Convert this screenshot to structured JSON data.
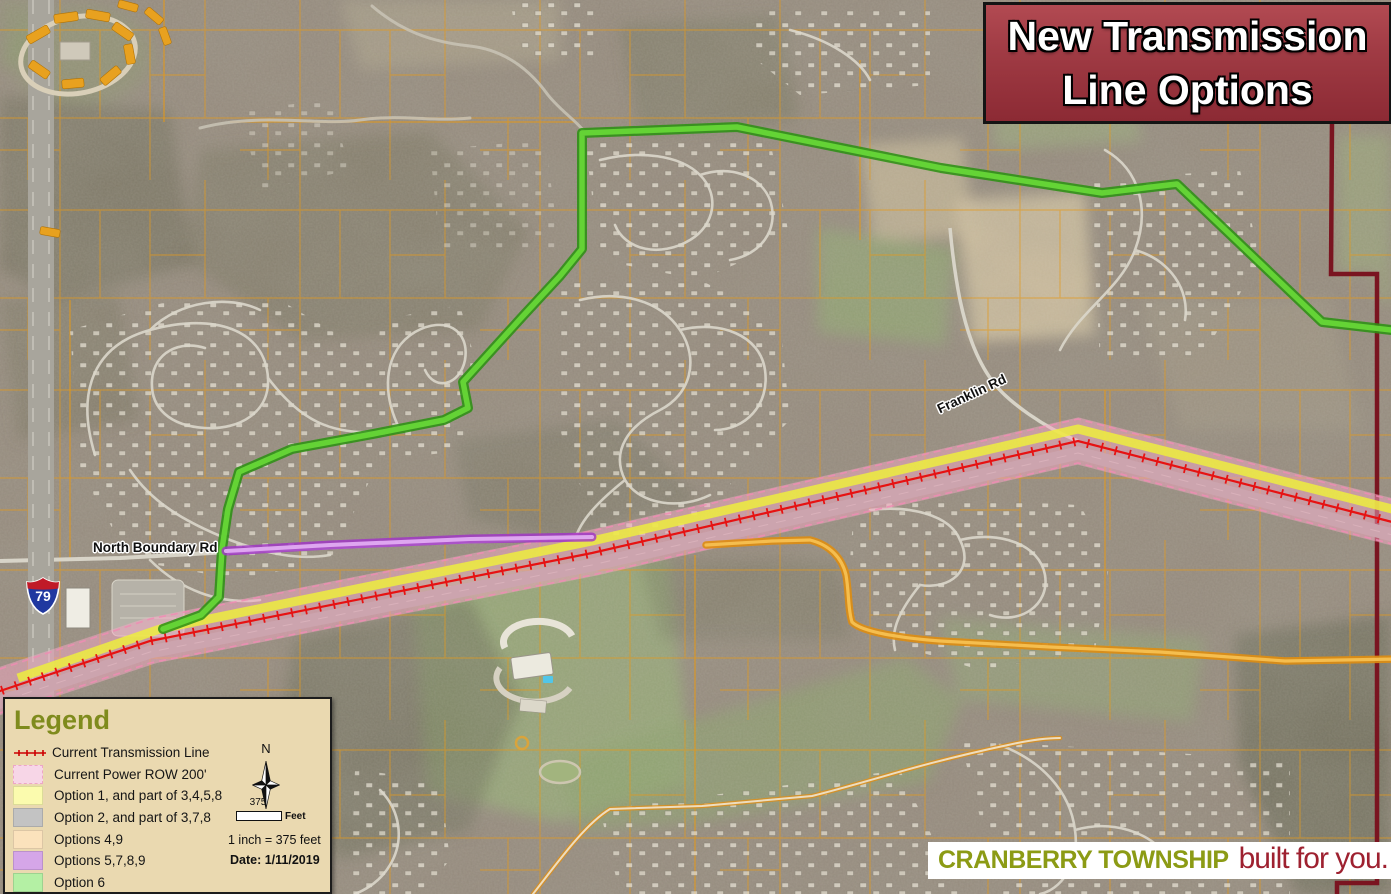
{
  "title_box": {
    "line1": "New Transmission",
    "line2": "Line Options"
  },
  "legend": {
    "title": "Legend",
    "items": [
      {
        "label": "Current Transmission Line",
        "symbol": "red-tick-line",
        "color": "#cc0000"
      },
      {
        "label": "Current Power ROW 200'",
        "symbol": "pink-swatch",
        "color": "#f7d6e7"
      },
      {
        "label": "Option 1, and part of 3,4,5,8",
        "symbol": "yellow-swatch",
        "color": "#fbfbae"
      },
      {
        "label": "Option 2, and part of 3,7,8",
        "symbol": "gray-swatch",
        "color": "#c3c3c3"
      },
      {
        "label": "Options 4,9",
        "symbol": "tan-swatch",
        "color": "#fbe2bc"
      },
      {
        "label": "Options 5,7,8,9",
        "symbol": "purple-swatch",
        "color": "#d5a6e8"
      },
      {
        "label": "Option 6",
        "symbol": "green-swatch",
        "color": "#b4f0a4"
      }
    ],
    "north_label": "N",
    "scale_value": "375",
    "scale_unit": "Feet",
    "scale_text": "1 inch = 375 feet",
    "date_text": "Date: 1/11/2019"
  },
  "map": {
    "road_labels": [
      {
        "text": "North Boundary Rd"
      },
      {
        "text": "Franklin Rd"
      }
    ],
    "interstate_shield": "79",
    "route_colors": {
      "current_transmission_line": "#e61212",
      "power_row_band": "#f6a8c4",
      "option1_yellow": "#eded3e",
      "option2_gray": "#a3a098",
      "options49_orange": "#de8d12",
      "options5789_purple": "#a032c8",
      "option6_green": "#46c41e",
      "township_boundary": "#7a1420",
      "parcel_lines": "#e2981c"
    }
  },
  "footer": {
    "township": "CRANBERRY TOWNSHIP",
    "tagline": "built for you."
  }
}
